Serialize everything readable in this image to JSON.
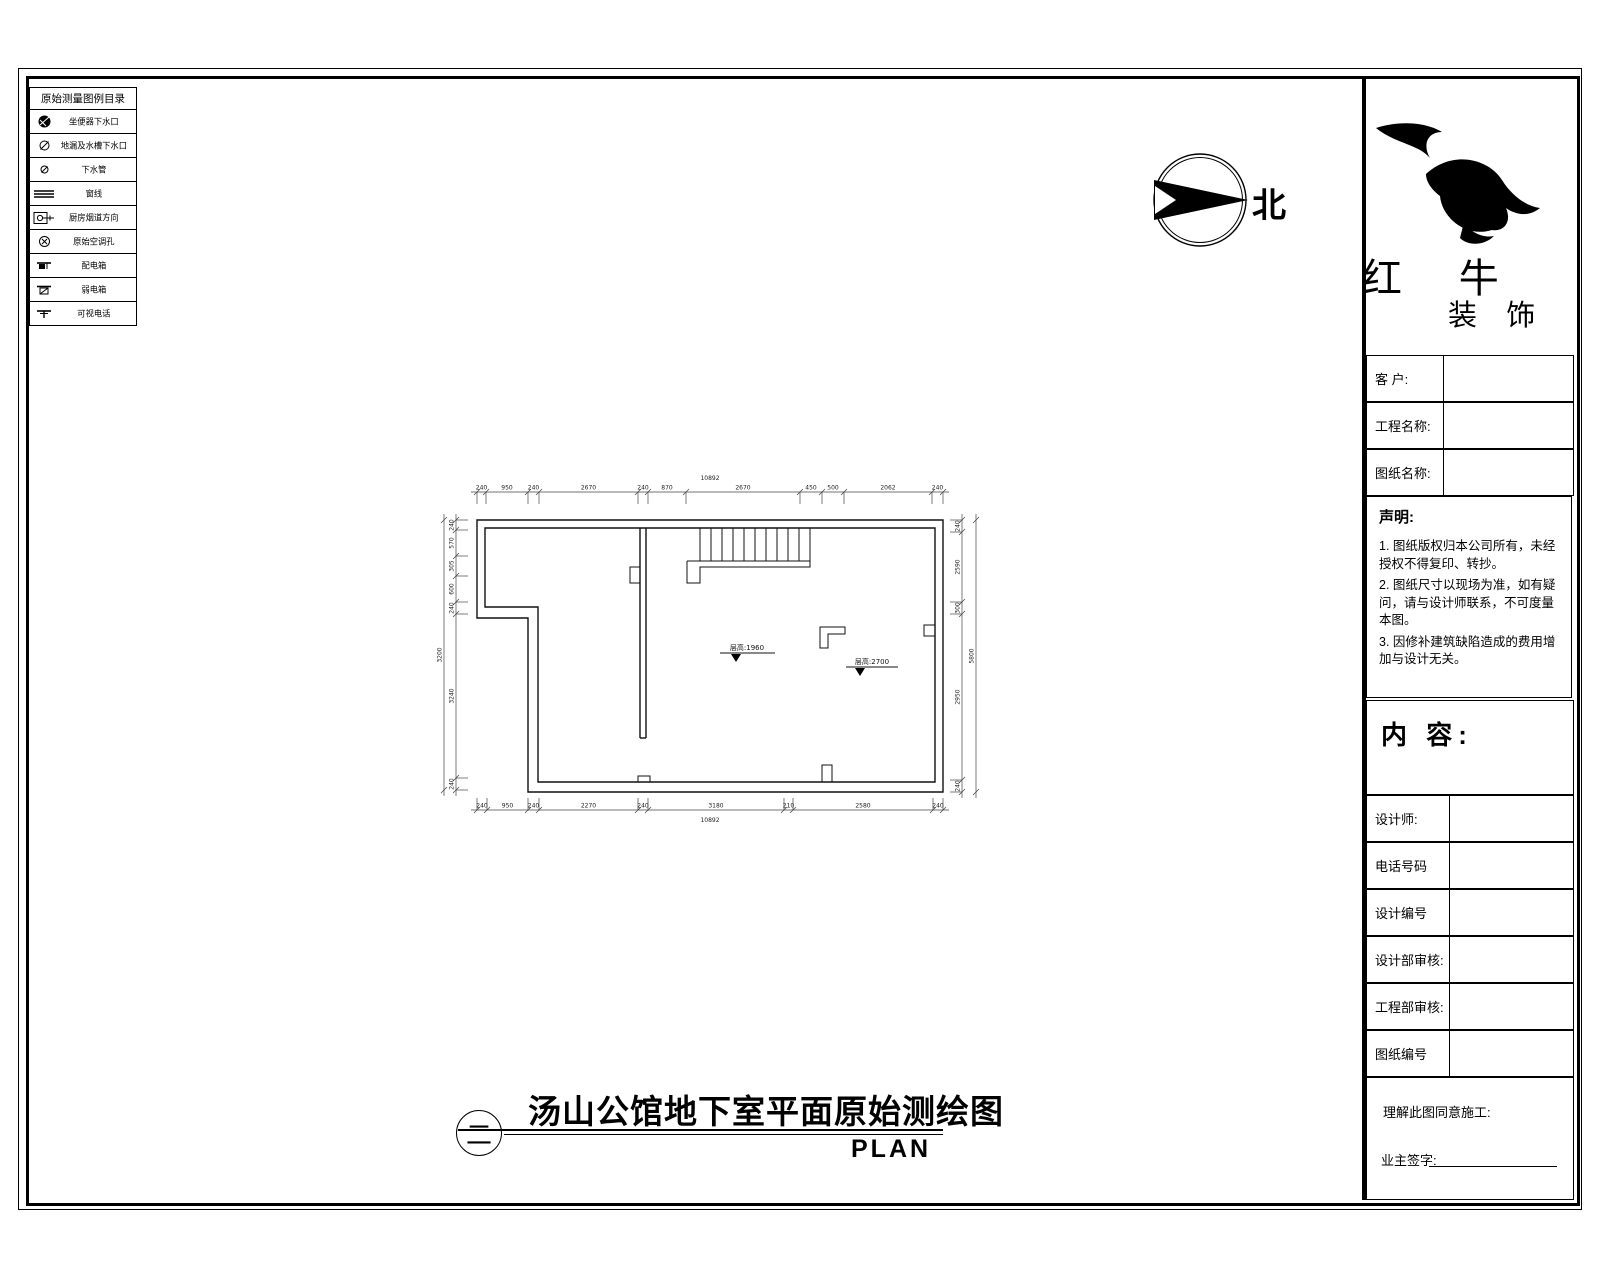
{
  "legend": {
    "title": "原始测量图例目录",
    "items": [
      {
        "icon": "toilet-drain-icon",
        "label": "坐便器下水口"
      },
      {
        "icon": "floor-drain-icon",
        "label": "地漏及水槽下水口"
      },
      {
        "icon": "drain-pipe-icon",
        "label": "下水管"
      },
      {
        "icon": "window-line-icon",
        "label": "窗线"
      },
      {
        "icon": "kitchen-flue-icon",
        "label": "厨房烟道方向"
      },
      {
        "icon": "ac-hole-icon",
        "label": "原始空调孔"
      },
      {
        "icon": "power-box-icon",
        "label": "配电箱"
      },
      {
        "icon": "weak-power-box-icon",
        "label": "弱电箱"
      },
      {
        "icon": "video-phone-icon",
        "label": "可视电话"
      }
    ]
  },
  "north": {
    "label": "北"
  },
  "brand": {
    "name_top": "红 牛",
    "name_bottom": "装 饰"
  },
  "titleblock": {
    "fields": [
      {
        "label": "客 户:"
      },
      {
        "label": "工程名称:"
      },
      {
        "label": "图纸名称:"
      }
    ],
    "statement": {
      "title": "声明:",
      "notes": [
        "1. 图纸版权归本公司所有，未经授权不得复印、转抄。",
        "2. 图纸尺寸以现场为准，如有疑问，请与设计师联系，不可度量本图。",
        "3. 因修补建筑缺陷造成的费用增加与设计无关。"
      ]
    },
    "content_label": "内 容:",
    "rows": [
      {
        "label": "设计师:"
      },
      {
        "label": "电话号码"
      },
      {
        "label": "设计编号"
      },
      {
        "label": "设计部审核:"
      },
      {
        "label": "工程部审核:"
      },
      {
        "label": "图纸编号"
      }
    ],
    "footer": {
      "agree": "理解此图同意施工:",
      "sign": "业主签字:"
    }
  },
  "plan": {
    "dims_top": {
      "total": "10892",
      "segments": [
        "240",
        "950",
        "240",
        "2670",
        "240",
        "870",
        "2670",
        "450",
        "500",
        "2062",
        "240"
      ]
    },
    "dims_bottom": {
      "total": "10892",
      "segments": [
        "240",
        "950",
        "240",
        "2270",
        "240",
        "3180",
        "210",
        "2580",
        "240"
      ]
    },
    "dims_left": {
      "total": "3200",
      "segments": [
        "240",
        "570",
        "305",
        "600",
        "240",
        "3240",
        "240"
      ]
    },
    "dims_right": {
      "total": "5800",
      "segments": [
        "240",
        "2590",
        "300",
        "2950",
        "240"
      ]
    },
    "levels": [
      {
        "label": "层高:1960"
      },
      {
        "label": "层高:2700"
      }
    ]
  },
  "footer_title": {
    "index": "二",
    "title": "汤山公馆地下室平面原始测绘图",
    "plan_label": "PLAN"
  }
}
